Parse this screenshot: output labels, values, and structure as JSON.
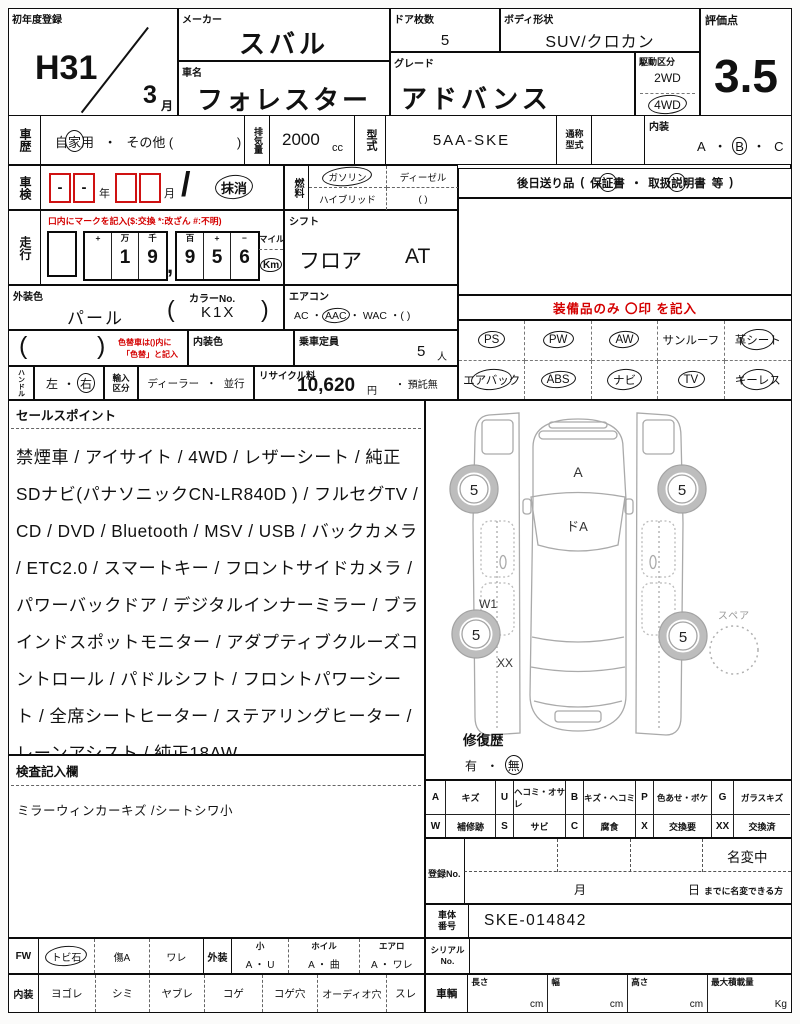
{
  "first_reg": {
    "label": "初年度登録",
    "era": "H31",
    "month": "3",
    "month_unit": "月"
  },
  "maker": {
    "label": "メーカー",
    "value": "スバル"
  },
  "car_name": {
    "label": "車名",
    "value": "フォレスター"
  },
  "doors": {
    "label": "ドア枚数",
    "value": "5"
  },
  "body": {
    "label": "ボディ形状",
    "value": "SUV/クロカン"
  },
  "grade": {
    "label": "グレード",
    "value": "アドバンス"
  },
  "drive": {
    "label": "駆動区分",
    "opt1": "2WD",
    "opt2": "4WD"
  },
  "score": {
    "label": "評価点",
    "value": "3.5"
  },
  "history": {
    "label": "車歴",
    "p1": "自",
    "c": "家",
    "p2": "用",
    "dot": "・",
    "other": "その他 (",
    "close": ")"
  },
  "displacement": {
    "label": "排気量",
    "value": "2000",
    "unit": "cc"
  },
  "model_code": {
    "label": "型式",
    "value": "5AA-SKE"
  },
  "common_code": {
    "label": "通称型式"
  },
  "interior_grade": {
    "label": "内装",
    "a": "A",
    "b": "B",
    "c": "C",
    "dot": "・"
  },
  "shaken": {
    "label": "車検",
    "d1": "-",
    "d2": "-",
    "year": "年",
    "month": "月",
    "slash": "/",
    "expired": "抹消"
  },
  "fuel": {
    "label": "燃料",
    "gasoline": "ガソリン",
    "diesel": "ディーゼル",
    "hybrid": "ハイブリッド",
    "other": "(          )"
  },
  "later_items": {
    "label": "後日送り品",
    "open": "(",
    "w1": "保",
    "w2": "証",
    "w3": "書",
    "dot": "・",
    "m1": "取扱",
    "m2": "説",
    "m3": "明書",
    "etc": "等",
    "close": ")"
  },
  "mileage": {
    "label": "走行",
    "note": "口内にマークを記入($:交換 *:改ざん #:不明)",
    "g1": [
      {
        "h": "+",
        "d": ""
      },
      {
        "h": "万",
        "d": "1"
      },
      {
        "h": "千",
        "d": "9"
      }
    ],
    "comma": ",",
    "g2": [
      {
        "h": "百",
        "d": "9"
      },
      {
        "h": "+",
        "d": "5"
      },
      {
        "h": "−",
        "d": "6"
      }
    ],
    "mile": "マイル",
    "km": "Km"
  },
  "shift": {
    "label": "シフト",
    "type": "フロア",
    "trans": "AT"
  },
  "ext_color": {
    "label": "外装色",
    "value": "パール",
    "no_label": "カラーNo.",
    "open": "(",
    "no": "K1X",
    "close": ")"
  },
  "aircon": {
    "label": "エアコン",
    "ac": "AC",
    "aac": "AAC",
    "wac": "WAC",
    "dot": "・",
    "other": "・(        )"
  },
  "color_change": {
    "open": "(",
    "close": ")",
    "note1": "色替車は()内に",
    "note2": "「色替」と記入"
  },
  "int_color": {
    "label": "内装色"
  },
  "capacity": {
    "label": "乗車定員",
    "value": "5",
    "unit": "人"
  },
  "handle": {
    "label": "ハンドル",
    "left": "左",
    "dot": "・",
    "right": "右"
  },
  "import": {
    "label": "輸入区分",
    "dealer": "ディーラー",
    "dot": "・",
    "parallel": "並行"
  },
  "recycle": {
    "label": "リサイクル料",
    "value": "10,620",
    "yen": "円",
    "deposit": "・ 預託無"
  },
  "equipment": {
    "title": "装備品のみ 〇印 を記入",
    "rows": [
      [
        {
          "label": "PS"
        },
        {
          "label": "PW"
        },
        {
          "label": "AW"
        },
        {
          "label": "サンルーフ"
        },
        {
          "label": "革シート"
        }
      ],
      [
        {
          "label": "エアバック"
        },
        {
          "label": "ABS"
        },
        {
          "label": "ナビ"
        },
        {
          "label": "TV"
        },
        {
          "label": "キーレス"
        }
      ]
    ]
  },
  "sales": {
    "label": "セールスポイント",
    "text": "禁煙車 / アイサイト / 4WD / レザーシート / 純正SDナビ(パナソニックCN-LR840D ) / フルセグTV / CD / DVD / Bluetooth / MSV / USB / バックカメラ / ETC2.0 / スマートキー / フロントサイドカメラ / パワーバックドア / デジタルインナーミラー / ブラインドスポットモニター / アダプティブクルーズコントロール / パドルシフト / フロントパワーシート / 全席シートヒーター / ステアリングヒーター / レーンアシスト / 純正18AW"
  },
  "inspection": {
    "label": "検査記入欄",
    "note": "ミラーウィンカーキズ /シートシワ小"
  },
  "diagram": {
    "hood": "A",
    "windshield": "ドA",
    "w1": "W1",
    "xx": "XX",
    "wheel": "5",
    "spare": "スペア"
  },
  "repair": {
    "label": "修復歴",
    "yes": "有",
    "dot": "・",
    "no": "無"
  },
  "legend": {
    "rows": [
      [
        {
          "k": "A",
          "v": "キズ"
        },
        {
          "k": "U",
          "v": "ヘコミ・オサレ"
        },
        {
          "k": "B",
          "v": "キズ・ヘコミ"
        },
        {
          "k": "P",
          "v": "色あせ・ボケ"
        },
        {
          "k": "G",
          "v": "ガラスキズ"
        }
      ],
      [
        {
          "k": "W",
          "v": "補修跡"
        },
        {
          "k": "S",
          "v": "サビ"
        },
        {
          "k": "C",
          "v": "腐食"
        },
        {
          "k": "X",
          "v": "交換要"
        },
        {
          "k": "XX",
          "v": "交換済"
        }
      ]
    ]
  },
  "registration": {
    "label": "登録No.",
    "status": "名変中",
    "month": "月",
    "day": "日",
    "note": "までに名変できる方"
  },
  "chassis": {
    "label": "車体番号",
    "value": "SKE-014842"
  },
  "fw_row": {
    "label": "FW",
    "i1": "トビ石",
    "i2": "傷A",
    "i3": "ワレ",
    "ext": "外装",
    "c1h": "小",
    "c1v": "A ・ U",
    "c2h": "ホイル",
    "c2v": "A ・ 曲",
    "c3h": "エアロ",
    "c3v": "A ・ ワレ"
  },
  "int_row": {
    "label": "内装",
    "items": [
      "ヨゴレ",
      "シミ",
      "ヤブレ",
      "コゲ",
      "コゲ穴",
      "オーディオ穴",
      "スレ"
    ]
  },
  "serial": {
    "label": "シリアルNo."
  },
  "vehicle": {
    "label": "車輌",
    "dims": [
      {
        "h": "長さ",
        "u": "cm"
      },
      {
        "h": "幅",
        "u": "cm"
      },
      {
        "h": "高さ",
        "u": "cm"
      },
      {
        "h": "最大積載量",
        "u": "Kg"
      }
    ]
  }
}
